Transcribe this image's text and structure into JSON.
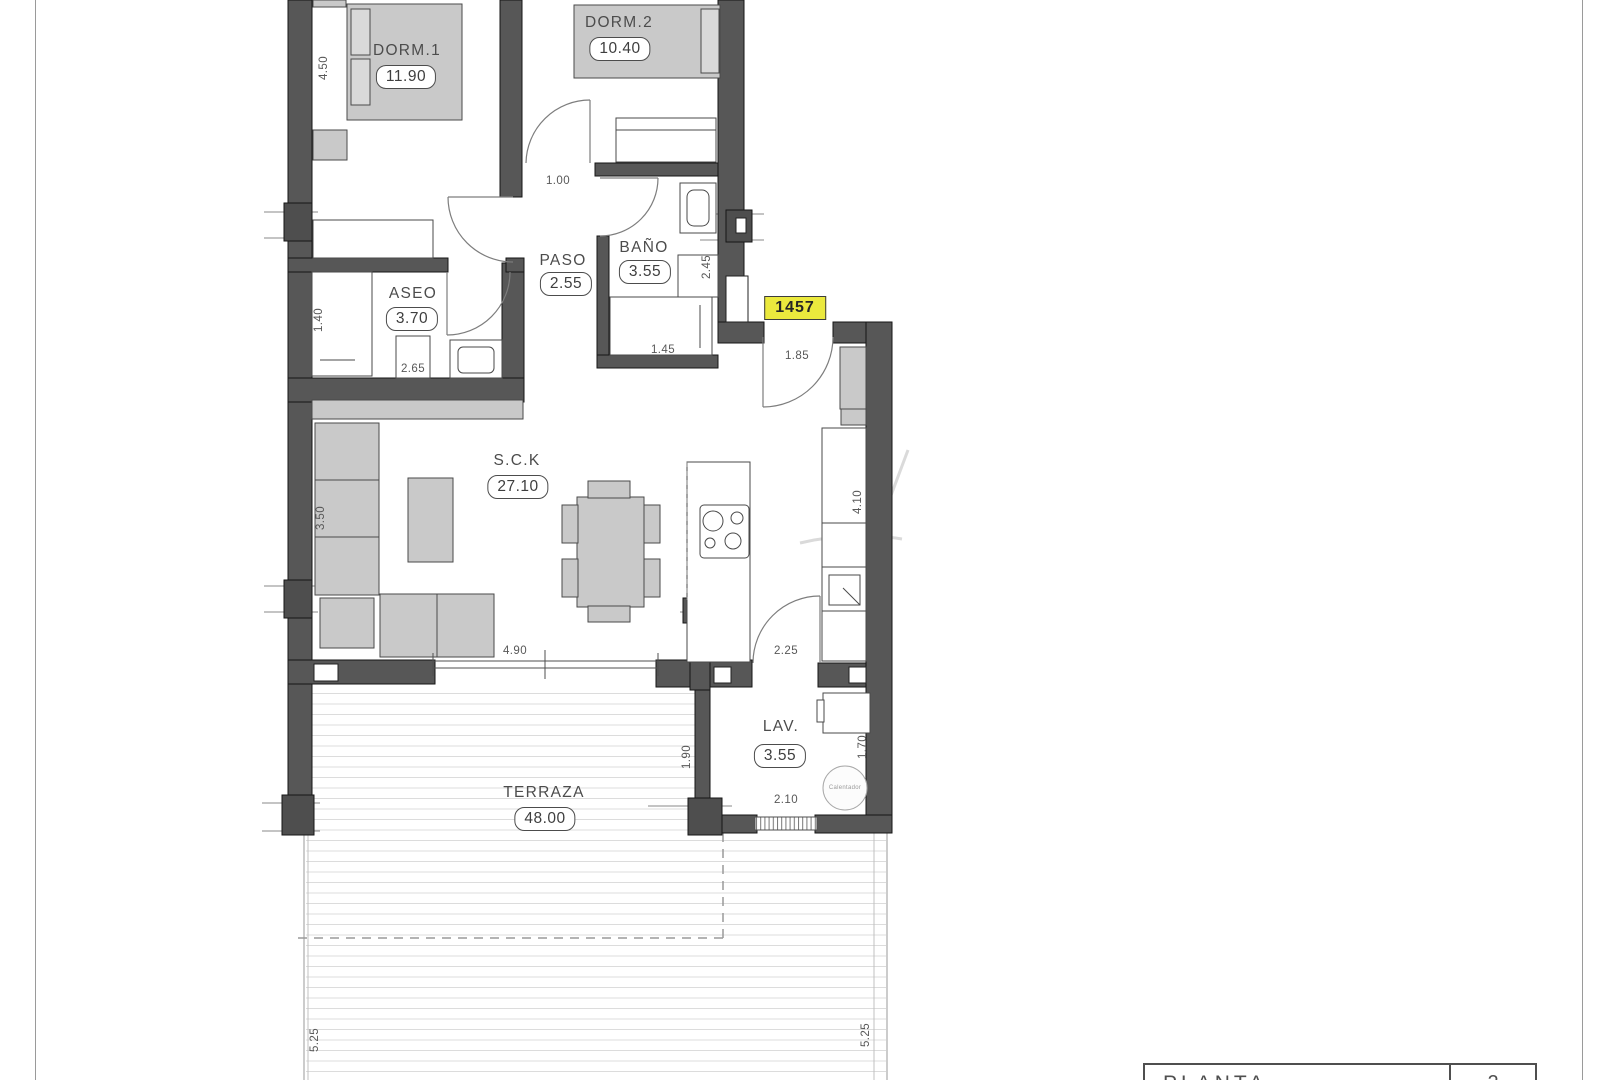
{
  "sheet": {
    "unit_badge": "1457",
    "title_block": {
      "label": "PLANTA",
      "number": "2"
    }
  },
  "rooms": [
    {
      "id": "dorm1",
      "name": "DORM.1",
      "area": "11.90"
    },
    {
      "id": "dorm2",
      "name": "DORM.2",
      "area": "10.40"
    },
    {
      "id": "aseo",
      "name": "ASEO",
      "area": "3.70"
    },
    {
      "id": "paso",
      "name": "PASO",
      "area": "2.55"
    },
    {
      "id": "bano",
      "name": "BAÑO",
      "area": "3.55"
    },
    {
      "id": "sck",
      "name": "S.C.K",
      "area": "27.10"
    },
    {
      "id": "lav",
      "name": "LAV.",
      "area": "3.55"
    },
    {
      "id": "terraza",
      "name": "TERRAZA",
      "area": "48.00"
    }
  ],
  "dimensions": [
    "4.50",
    "1.00",
    "1.40",
    "2.65",
    "2.45",
    "1.45",
    "1.85",
    "3.50",
    "4.10",
    "4.90",
    "2.25",
    "1.90",
    "1.70",
    "2.10",
    "5.25",
    "5.25"
  ],
  "equipment": {
    "calentador": "Calentador"
  },
  "colors": {
    "wall": "#575757",
    "furniture": "#c9c9c9",
    "badge_yellow": "#ebe93d"
  }
}
